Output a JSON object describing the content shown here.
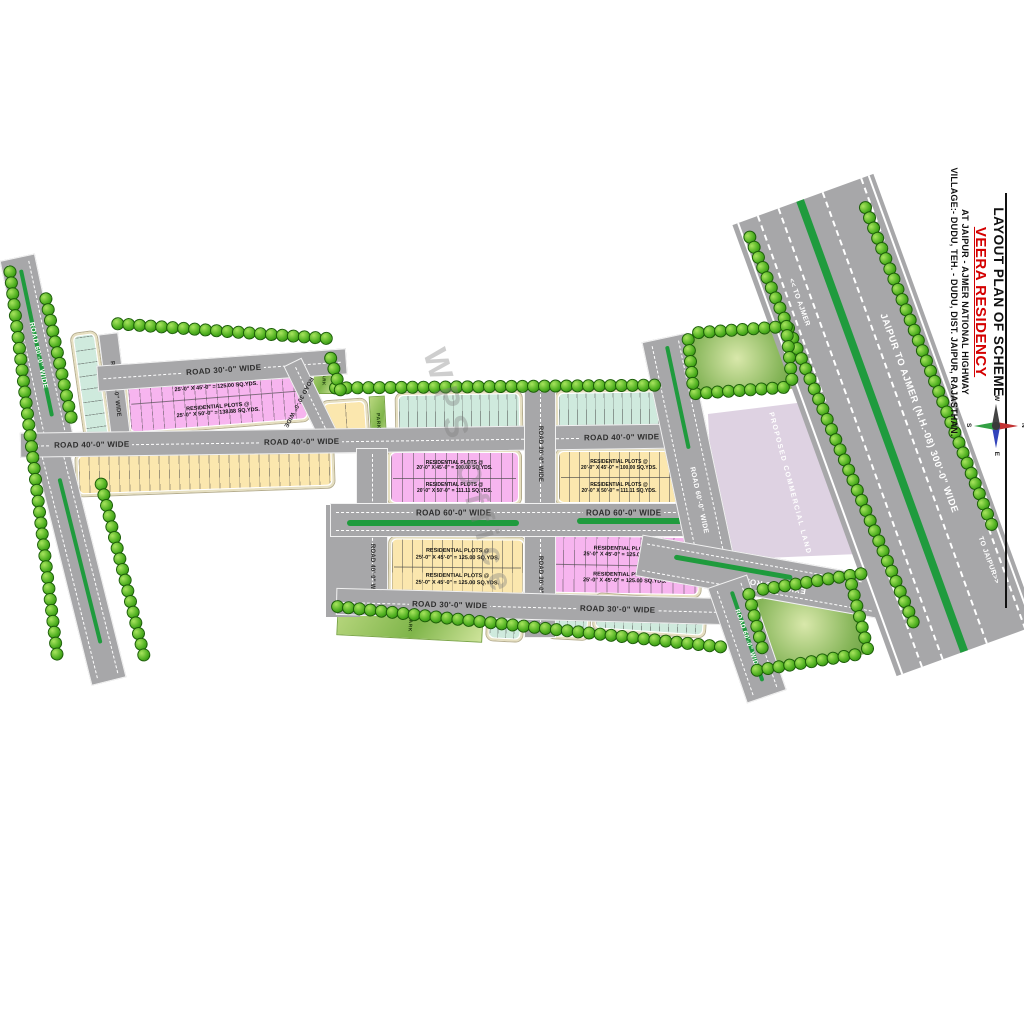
{
  "title": {
    "line1": "LAYOUT PLAN OF SCHEME",
    "line2": "VEERA RESIDENCY",
    "line3": "AT JAIPUR - AJMER NATIONAL HIGHWAY",
    "line4": "VILLAGE:- DUDU, TEH. - DUDU, DIST. JAIPUR, RAJASTHAN."
  },
  "compass": {
    "n": "N",
    "e": "E",
    "s": "S",
    "w": "W"
  },
  "roads": {
    "r30": "ROAD 30'-0\" WIDE",
    "r40": "ROAD 40'-0\" WIDE",
    "r60": "ROAD 60'-0\" WIDE",
    "highway": "JAIPUR TO AJMER (N.H.-08) 300'-0\" WIDE",
    "to_ajmer": "<< TO AJMER",
    "to_jaipur": "TO JAIPUR>>",
    "existing": "EXISTING ROAD"
  },
  "blocks": {
    "header": "RESIDENTIAL PLOTS @",
    "tl": {
      "row1": "25'-0\" X 45'-0\" = 125.00 SQ.YDS.",
      "row2": "25'-0\" X 50'-0\" = 138.88 SQ.YDS."
    },
    "center": {
      "row1": "20'-0\" X 45'-0\" = 100.00 SQ.YDS.",
      "row2": "20'-0\" X 50'-0\" = 111.11 SQ.YDS."
    },
    "bottom": {
      "row1": "25'-0\" X 45'-0\" = 125.00 SQ.YDS.",
      "row2": "25'-0\" X 45'-0\" = 125.00 SQ.YDS."
    }
  },
  "areas": {
    "commercial": "PROPOSED COMMERCIAL LAND",
    "park": "PARK"
  },
  "watermark": {
    "text": "WPS Office"
  },
  "colors": {
    "road_gray": "#a7a7a9",
    "median_green": "#1f9b3d",
    "tree_green": "#4cae1e",
    "plot_pink": "#f7b5ef",
    "plot_yellow": "#fbe7ae",
    "plot_teal": "#cfeadd",
    "commercial_lavender": "#ded2e2",
    "accent_red": "#d40000"
  }
}
